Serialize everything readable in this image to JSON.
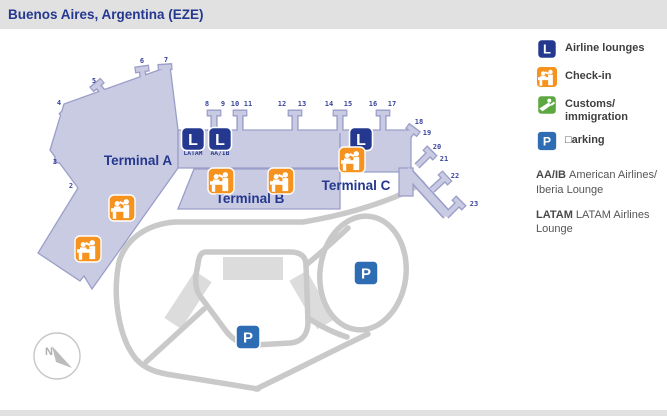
{
  "header": {
    "title": "Buenos Aires, Argentina (EZE)"
  },
  "legend": {
    "items": [
      {
        "id": "lounges",
        "icon": "airline-lounge-icon",
        "label": "Airline lounges"
      },
      {
        "id": "checkin",
        "icon": "check-in-icon",
        "label": "Check-in"
      },
      {
        "id": "customs",
        "icon": "customs-immigration-icon",
        "label": "Customs/\nimmigration"
      },
      {
        "id": "parking",
        "icon": "parking-icon",
        "label": "□arking"
      }
    ],
    "lounges": [
      {
        "code": "AA/IB",
        "name": "American Airlines/ Iberia Lounge"
      },
      {
        "code": "LATAM",
        "name": "LATAM Airlines Lounge"
      }
    ]
  },
  "icons": {
    "lounge_glyph": "L",
    "parking_glyph": "P"
  },
  "map": {
    "terminals": [
      {
        "id": "a",
        "label": "Terminal A",
        "x": 138,
        "y": 165
      },
      {
        "id": "b",
        "label": "Terminal B",
        "x": 250,
        "y": 203
      },
      {
        "id": "c",
        "label": "Terminal C",
        "x": 356,
        "y": 190
      }
    ],
    "gates": [
      {
        "n": "2",
        "x": 71,
        "y": 188
      },
      {
        "n": "3",
        "x": 55,
        "y": 164
      },
      {
        "n": "4",
        "x": 59,
        "y": 105
      },
      {
        "n": "5",
        "x": 94,
        "y": 83
      },
      {
        "n": "6",
        "x": 142,
        "y": 63
      },
      {
        "n": "7",
        "x": 166,
        "y": 62
      },
      {
        "n": "8",
        "x": 207,
        "y": 106
      },
      {
        "n": "9",
        "x": 223,
        "y": 106
      },
      {
        "n": "10",
        "x": 235,
        "y": 106
      },
      {
        "n": "11",
        "x": 248,
        "y": 106
      },
      {
        "n": "12",
        "x": 282,
        "y": 106
      },
      {
        "n": "13",
        "x": 302,
        "y": 106
      },
      {
        "n": "14",
        "x": 329,
        "y": 106
      },
      {
        "n": "15",
        "x": 348,
        "y": 106
      },
      {
        "n": "16",
        "x": 373,
        "y": 106
      },
      {
        "n": "17",
        "x": 392,
        "y": 106
      },
      {
        "n": "18",
        "x": 419,
        "y": 124
      },
      {
        "n": "19",
        "x": 427,
        "y": 135
      },
      {
        "n": "20",
        "x": 437,
        "y": 149
      },
      {
        "n": "21",
        "x": 444,
        "y": 161
      },
      {
        "n": "22",
        "x": 455,
        "y": 178
      },
      {
        "n": "23",
        "x": 474,
        "y": 206
      }
    ],
    "lounge_icons": [
      {
        "x": 193,
        "y": 139,
        "tag": "LATAM"
      },
      {
        "x": 220,
        "y": 139,
        "tag": "AA/IB"
      },
      {
        "x": 361,
        "y": 139,
        "tag": ""
      }
    ],
    "checkin_icons": [
      {
        "x": 122,
        "y": 208
      },
      {
        "x": 88,
        "y": 249
      },
      {
        "x": 221,
        "y": 181
      },
      {
        "x": 281,
        "y": 181
      },
      {
        "x": 352,
        "y": 160
      }
    ],
    "parking_icons": [
      {
        "x": 366,
        "y": 273
      },
      {
        "x": 248,
        "y": 337
      }
    ],
    "compass": {
      "label": "N"
    }
  },
  "colors": {
    "terminal_fill": "#C9CBE2",
    "terminal_stroke": "#9B9EC9",
    "navy": "#24388F",
    "gate_text": "#3A449B",
    "road": "#C9C9C9",
    "lot": "#DCDCDC",
    "orange": "#F6921E",
    "green": "#5EA843",
    "blue": "#2E6DB4",
    "header_bg": "#E1E1E1",
    "text_dark": "#3F3F3F"
  }
}
